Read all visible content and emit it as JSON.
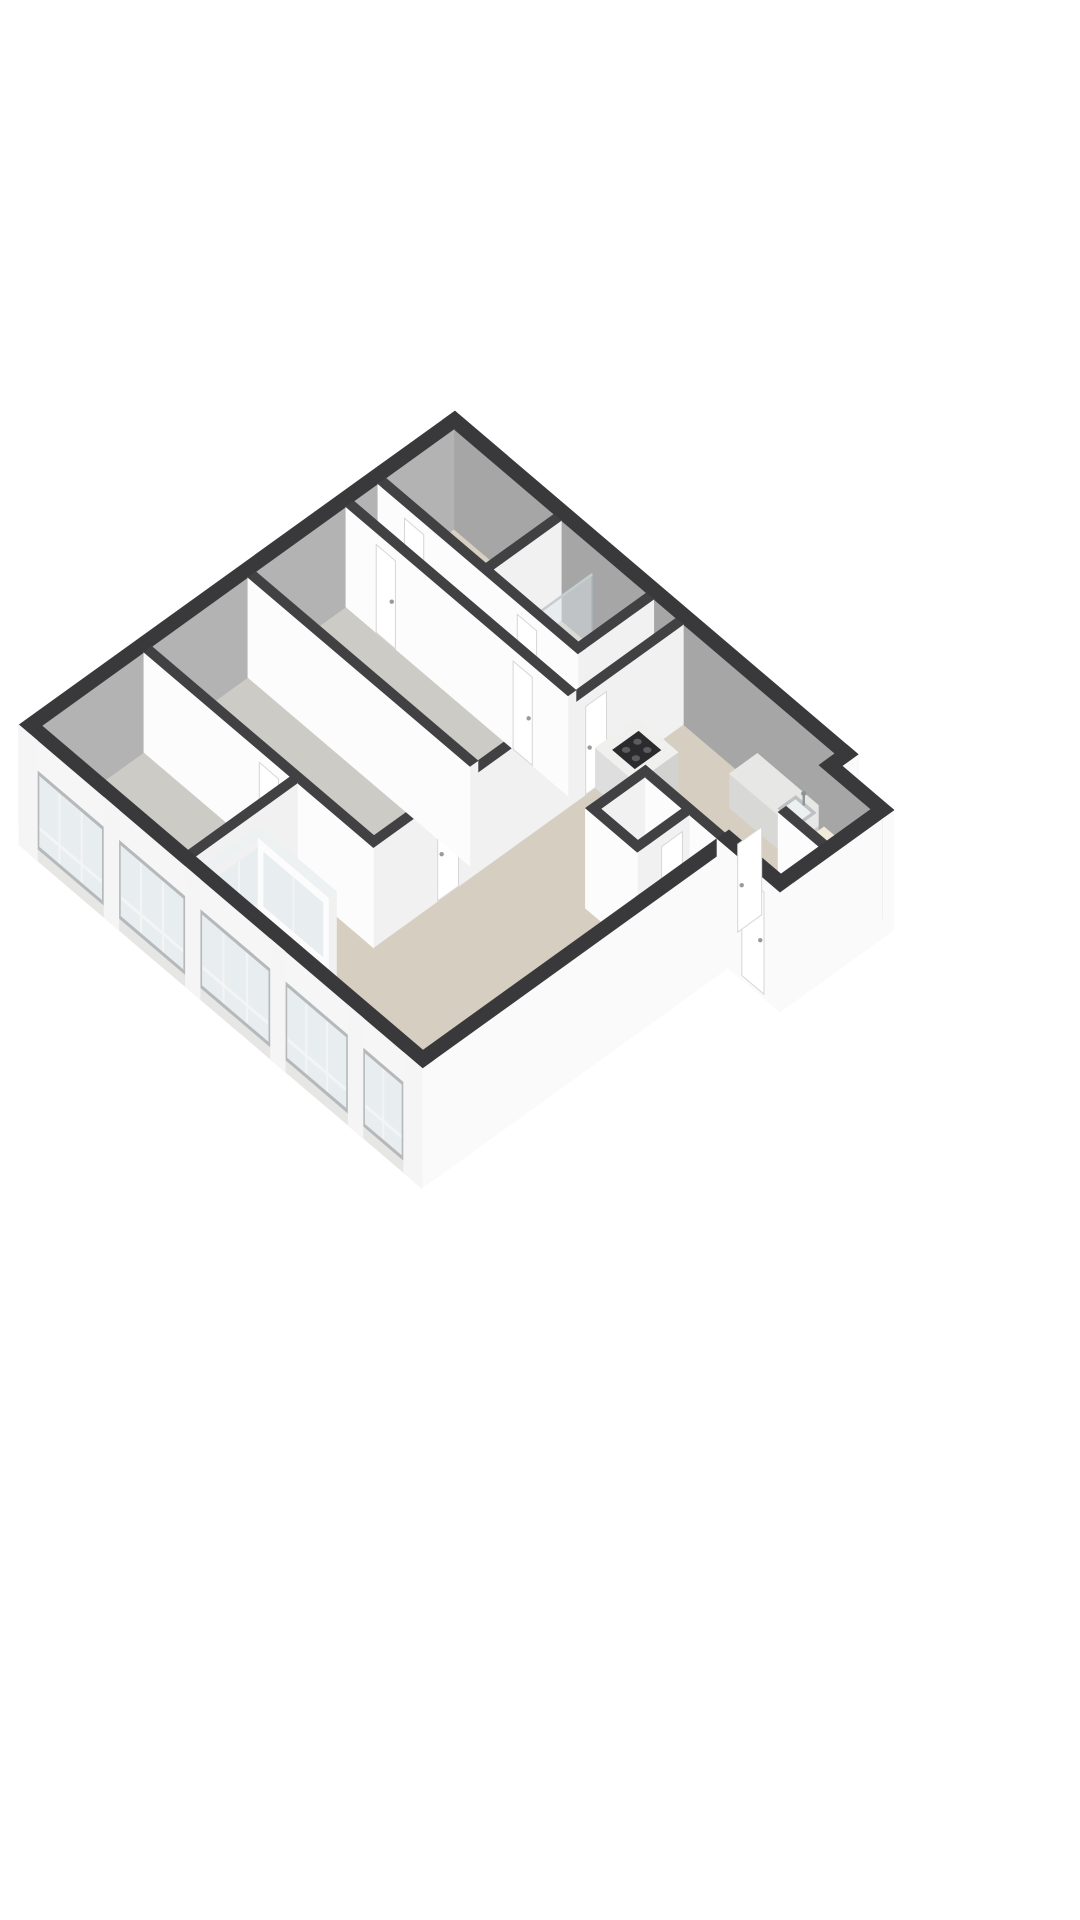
{
  "meta": {
    "title": "3D isometric floor plan render",
    "background": "#ffffff"
  },
  "scene": {
    "origin": [
      455,
      508
    ],
    "u": [
      37,
      31.5
    ],
    "v": [
      -40,
      28.8
    ],
    "wallH": 100,
    "facadeDrop": 20,
    "colors": {
      "extTop": "#39393b",
      "intTop": "#414143",
      "innerN": "#a6a6a6",
      "innerW": "#b3b3b3",
      "extWhite": "#fafafa",
      "intFacePy": "#fcfcfc",
      "intFacePx": "#f1f1f1",
      "lintel": "#f6f6f6",
      "sill": "#e6e6e4",
      "pier": "#f5f5f5",
      "winFrame": "#b5b9bb",
      "pane": "#e8edef",
      "mullion": "#f3f4f4",
      "glassFill": "#dde6ea",
      "glassFrame": "#a9b2b7",
      "glassTop": "#eef1f2",
      "beige": "#d8d1c2",
      "gray": "#cdcbc5",
      "living": "#d6cfc1",
      "loggia": "#d0cabc",
      "counterTop": "#e7e7e5",
      "counterPy": "#d8d8d6",
      "counterPx": "#cccccb",
      "sinkRim": "#bdc1c3",
      "sinkIn": "#edf0f1",
      "faucet": "#8d9497",
      "islandTop": "#f0f0ee",
      "islandPy": "#dedede",
      "islandPx": "#d2d2d0",
      "cooktop": "#2b2b2d",
      "burner": "#5c5c5e",
      "creamTop": "#f1ead9",
      "creamPy": "#eae2cc",
      "creamPx": "#ded4b8",
      "basinTop": "#fcfcfc",
      "basinPy": "#ececec",
      "basinPx": "#e2e2e2",
      "door": "#ffffff",
      "doorStroke": "#d6d6d6",
      "handle": "#9a9a9a",
      "towel": "#c7ccce"
    },
    "elements": [
      {
        "k": "floor",
        "n": "floor-utility-room",
        "r": [
          0.35,
          0.35,
          3.15,
          2.15
        ],
        "c": "beige"
      },
      {
        "k": "floor",
        "n": "floor-bathroom",
        "r": [
          3.25,
          0.35,
          5.65,
          2.15
        ],
        "c": "beige"
      },
      {
        "k": "floor",
        "n": "floor-corridor",
        "r": [
          5.75,
          0.35,
          6.45,
          2.25
        ],
        "c": "beige"
      },
      {
        "k": "floor",
        "n": "floor-hallway",
        "r": [
          0.35,
          2.25,
          6.45,
          2.95
        ],
        "c": "beige"
      },
      {
        "k": "floor",
        "n": "floor-room-1",
        "r": [
          0.35,
          3.05,
          6.45,
          5.4
        ],
        "c": "gray"
      },
      {
        "k": "floor",
        "n": "floor-room-2",
        "r": [
          0.35,
          5.5,
          6.45,
          8.0
        ],
        "c": "gray"
      },
      {
        "k": "floor",
        "n": "floor-room-3",
        "r": [
          0.35,
          8.1,
          4.45,
          10.65
        ],
        "c": "gray"
      },
      {
        "k": "floor",
        "n": "floor-living-room",
        "p": [
          [
            6.55,
            0.35
          ],
          [
            10.8,
            0.35
          ],
          [
            10.8,
            10.65
          ],
          [
            4.5,
            10.65
          ],
          [
            4.5,
            8.1
          ],
          [
            6.55,
            8.1
          ]
        ],
        "c": "living"
      },
      {
        "k": "floor",
        "n": "floor-entry-wing",
        "r": [
          10.65,
          0.75,
          12.2,
          3.0
        ],
        "c": "beige"
      },
      {
        "k": "floor",
        "n": "floor-loggia",
        "r": [
          4.95,
          9.5,
          6.85,
          10.65
        ],
        "c": "loggia"
      },
      {
        "k": "wall",
        "n": "wall-facade-north",
        "r": [
          0.05,
          0.05,
          10.95,
          0.35
        ],
        "top": "extTop",
        "py": "innerN",
        "px": "innerN"
      },
      {
        "k": "wall",
        "n": "wall-facade-west",
        "r": [
          0.05,
          0.35,
          0.35,
          10.95
        ],
        "top": "extTop",
        "py": "innerW",
        "px": "innerW"
      },
      {
        "k": "shower",
        "n": "shower-enclosure-1",
        "r": [
          2.05,
          0.55,
          2.9,
          1.9
        ]
      },
      {
        "k": "wall",
        "n": "wall-utility-bathroom",
        "r": [
          3.05,
          0.35,
          3.25,
          2.25
        ]
      },
      {
        "k": "shower",
        "n": "shower-enclosure-2",
        "r": [
          3.45,
          0.55,
          4.3,
          1.95
        ]
      },
      {
        "k": "box",
        "n": "washbasin",
        "r": [
          4.85,
          1.5,
          5.45,
          1.98
        ],
        "h": 26,
        "top": "basinTop",
        "py": "basinPy",
        "px": "basinPx",
        "faucet": [
          5.15,
          1.58
        ]
      },
      {
        "k": "wall",
        "n": "wall-bathroom-corridor",
        "r": [
          5.55,
          0.35,
          5.75,
          2.25
        ]
      },
      {
        "k": "bar",
        "n": "towel-rail",
        "plane": "px",
        "at": 5.78,
        "from": 0.78,
        "to": 1.32,
        "z0": 54,
        "z1": 58,
        "c": "towel"
      },
      {
        "k": "wall",
        "n": "wall-hallway-north",
        "r": [
          0.35,
          2.05,
          5.75,
          2.25
        ]
      },
      {
        "k": "door",
        "n": "door-utility",
        "plane": "py",
        "at": 2.25,
        "from": 1.1,
        "to": 1.62
      },
      {
        "k": "door",
        "n": "door-bathroom",
        "plane": "py",
        "at": 2.25,
        "from": 4.15,
        "to": 4.67
      },
      {
        "k": "box",
        "n": "kitchen-counter",
        "r": [
          8.55,
          0.35,
          10.55,
          1.05
        ],
        "h": 34,
        "top": "counterTop",
        "py": "counterPy",
        "px": "counterPx",
        "sink": [
          9.75,
          0.5,
          10.3,
          0.95
        ],
        "faucet": [
          10.02,
          0.55
        ]
      },
      {
        "k": "wall",
        "n": "wall-facade-east-a",
        "r": [
          10.65,
          0.05,
          10.95,
          0.45
        ],
        "top": "extTop",
        "py": "extWhite",
        "px": "extWhite",
        "dpx": -20
      },
      {
        "k": "wall",
        "n": "wall-living-west",
        "r": [
          6.35,
          0.35,
          6.55,
          8.1
        ]
      },
      {
        "k": "door",
        "n": "door-living-hall",
        "plane": "px",
        "at": 6.55,
        "from": 2.3,
        "to": 2.82
      },
      {
        "k": "door",
        "n": "door-living-room2",
        "plane": "px",
        "at": 6.55,
        "from": 6.0,
        "to": 6.52
      },
      {
        "k": "box",
        "n": "kitchen-island",
        "r": [
          6.55,
          1.5,
          7.65,
          2.55
        ],
        "h": 40,
        "top": "islandTop",
        "py": "islandPy",
        "px": "islandPx",
        "cooktop": [
          6.8,
          1.7,
          7.4,
          2.35
        ]
      },
      {
        "k": "wall",
        "n": "wall-hall-room1",
        "r": [
          0.35,
          2.85,
          6.35,
          3.05
        ]
      },
      {
        "k": "door",
        "n": "door-room1-a",
        "plane": "py",
        "at": 3.05,
        "from": 1.2,
        "to": 1.72
      },
      {
        "k": "door",
        "n": "door-room1-b",
        "plane": "py",
        "at": 3.05,
        "from": 4.9,
        "to": 5.42
      },
      {
        "k": "wall",
        "n": "wall-room1-room2",
        "r": [
          0.35,
          5.3,
          6.35,
          5.5
        ]
      },
      {
        "k": "wall",
        "n": "wall-wc-north",
        "r": [
          8.5,
          3.1,
          10.65,
          3.3
        ]
      },
      {
        "k": "wall",
        "n": "wall-wc-west",
        "r": [
          8.5,
          3.3,
          8.7,
          4.6
        ]
      },
      {
        "k": "wall",
        "n": "wall-wc-divider",
        "r": [
          9.7,
          3.3,
          9.9,
          4.4
        ]
      },
      {
        "k": "door",
        "n": "door-wc",
        "plane": "px",
        "at": 9.9,
        "from": 3.5,
        "to": 4.02
      },
      {
        "k": "wall",
        "n": "wall-wc-south",
        "r": [
          8.5,
          4.4,
          9.9,
          4.6
        ]
      },
      {
        "k": "wall",
        "n": "wall-room2-south",
        "r": [
          0.35,
          7.9,
          6.55,
          8.1
        ]
      },
      {
        "k": "door",
        "n": "door-room3",
        "plane": "py",
        "at": 8.1,
        "from": 3.5,
        "to": 4.02
      },
      {
        "k": "wall",
        "n": "wall-room3-living",
        "r": [
          4.3,
          8.1,
          4.5,
          10.65
        ]
      },
      {
        "k": "glazed",
        "n": "loggia-glass-west",
        "r": [
          4.75,
          9.3,
          4.95,
          10.65
        ],
        "face": "px"
      },
      {
        "k": "glazed",
        "n": "loggia-glass-north",
        "r": [
          4.95,
          9.3,
          6.85,
          9.5
        ],
        "face": "py"
      },
      {
        "k": "wall",
        "n": "wall-facade-east-b",
        "r": [
          10.65,
          3.3,
          10.95,
          10.95
        ],
        "top": "extTop",
        "py": "extWhite",
        "px": "extWhite",
        "dpx": -20,
        "dpy": -20
      },
      {
        "k": "facadeS",
        "n": "window-facade-south",
        "band": [
          0.35,
          10.65,
          10.95,
          10.95
        ],
        "lintelZ": [
          70,
          100
        ],
        "winZ": [
          -8,
          70
        ],
        "sillZ": [
          -20,
          -8
        ],
        "sections": [
          {
            "x0": 0.55,
            "x1": 2.35,
            "mullions": 2
          },
          {
            "x0": 2.75,
            "x1": 4.55,
            "mullions": 2
          },
          {
            "x0": 4.95,
            "x1": 6.85,
            "mullions": 2
          },
          {
            "x0": 7.25,
            "x1": 8.95,
            "mullions": 2
          },
          {
            "x0": 9.35,
            "x1": 10.45,
            "mullions": 1
          }
        ],
        "piers": [
          [
            0.05,
            0.55
          ],
          [
            2.35,
            2.75
          ],
          [
            4.55,
            4.95
          ],
          [
            6.85,
            7.25
          ],
          [
            8.95,
            9.35
          ],
          [
            10.45,
            10.95
          ]
        ]
      },
      {
        "k": "wall",
        "n": "wing-wall-north",
        "r": [
          10.65,
          0.45,
          12.35,
          0.75
        ],
        "top": "extTop",
        "py": "innerN",
        "px": "extWhite",
        "dpx": -20
      },
      {
        "k": "box",
        "n": "wing-cabinet",
        "r": [
          11.0,
          0.95,
          11.75,
          1.75
        ],
        "h": 55,
        "top": "creamTop",
        "py": "creamPy",
        "px": "creamPx"
      },
      {
        "k": "wall",
        "n": "wing-wall-divider",
        "r": [
          10.95,
          1.85,
          12.05,
          2.05
        ]
      },
      {
        "k": "wall",
        "n": "wing-wall-east",
        "r": [
          12.05,
          0.75,
          12.35,
          3.3
        ],
        "top": "extTop",
        "py": "extWhite",
        "px": "extWhite",
        "dpx": -20,
        "dpy": -20
      },
      {
        "k": "wall",
        "n": "wing-wall-south",
        "r": [
          10.65,
          3.0,
          12.35,
          3.3
        ],
        "top": "extTop",
        "py": "extWhite",
        "px": "extWhite",
        "dpy": -20
      },
      {
        "k": "door",
        "n": "entrance-door",
        "plane": "py",
        "at": 3.3,
        "from": 11.35,
        "to": 11.95,
        "z0": -14,
        "z1": 88
      },
      {
        "k": "door",
        "n": "door-living-wing",
        "plane": "px",
        "at": 10.8,
        "from": 2.35,
        "to": 2.95
      }
    ]
  }
}
